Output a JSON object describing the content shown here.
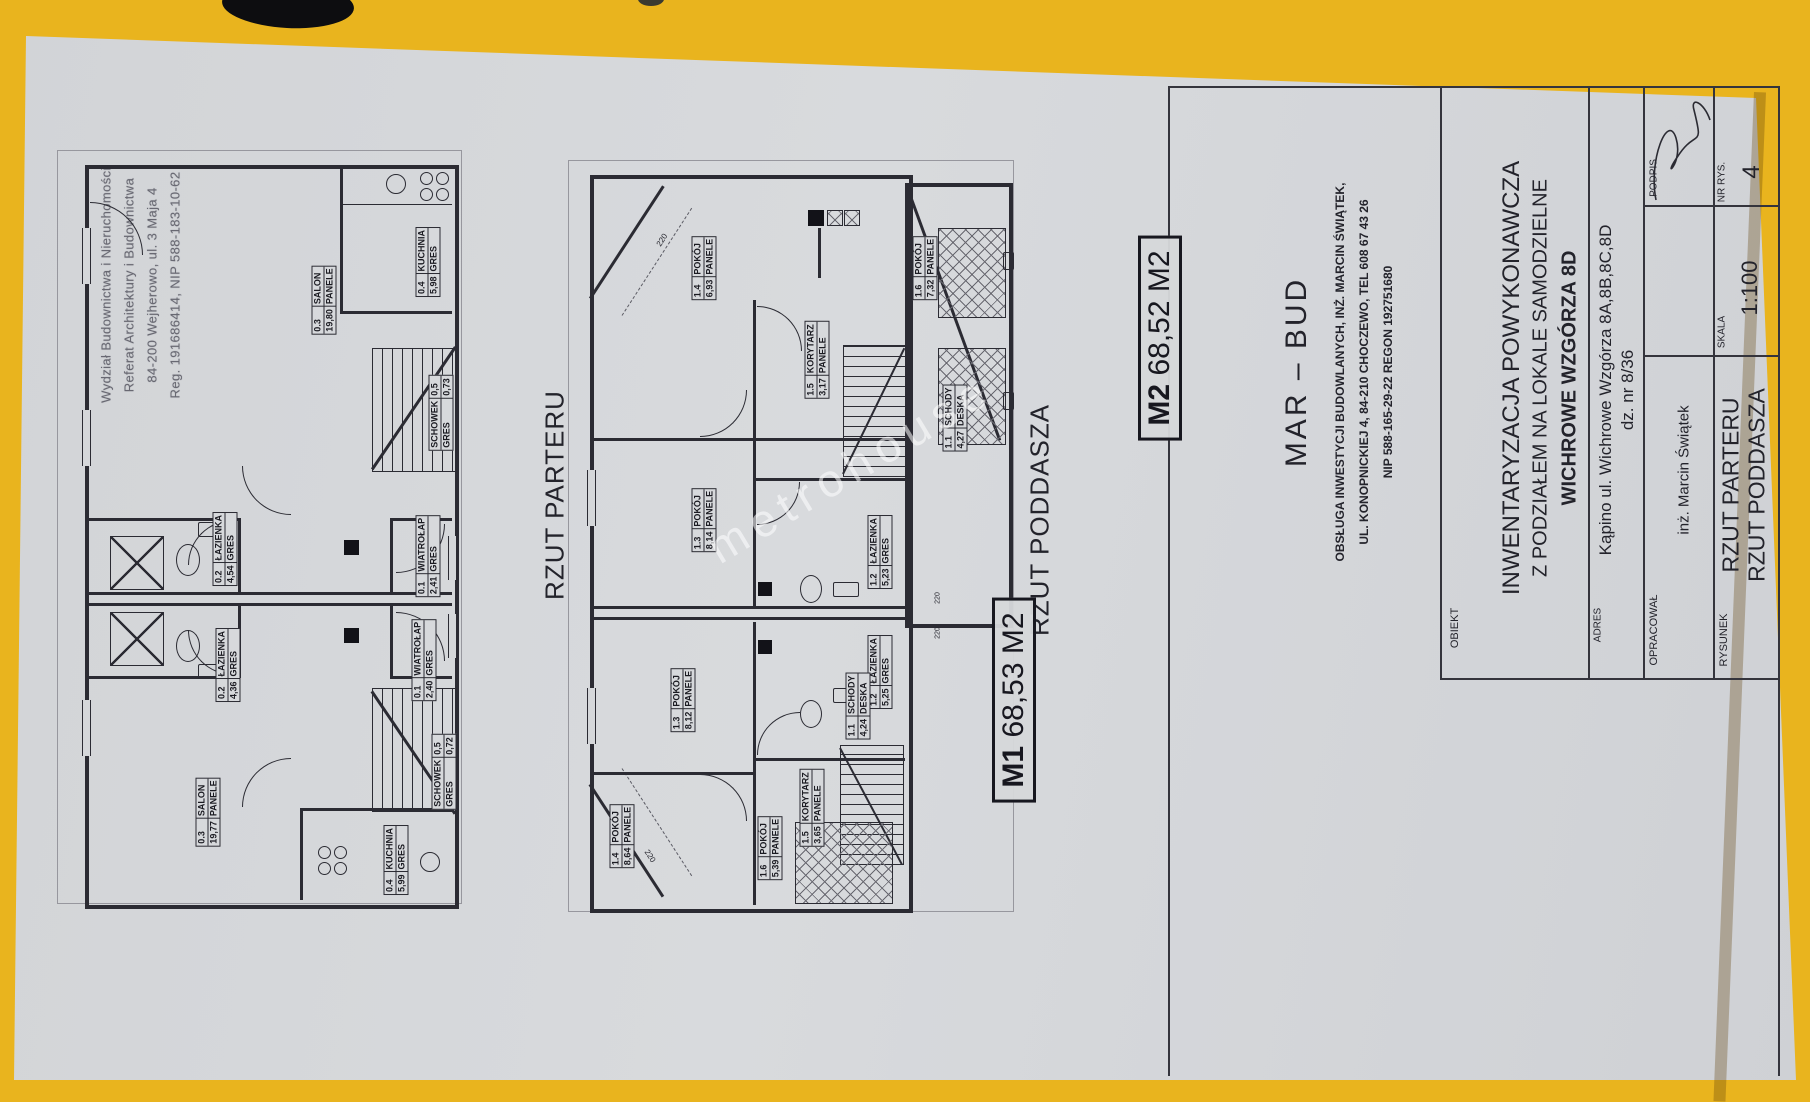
{
  "photo": {
    "surface_color": "#e9b41e",
    "paper_color": "#d4d6d9",
    "ink_color": "#2b2b33"
  },
  "watermark": {
    "text": "metrohouse"
  },
  "stamp": {
    "lines": [
      "Wydział Budownictwa i Nieruchomości",
      "Referat Architektury i Budownictwa",
      "84-200 Wejherowo, ul. 3 Maja 4",
      "Reg. 191686414, NIP 588-183-10-62"
    ]
  },
  "plan_titles": {
    "parter": "RZUT PARTERU",
    "poddasze": "RZUT PODDASZA"
  },
  "unit_badges": {
    "m1": {
      "code": "M1",
      "area": "68,53 M2"
    },
    "m2": {
      "code": "M2",
      "area": "68,52 M2"
    }
  },
  "dims": {
    "a": "220",
    "b": "220",
    "c": "220",
    "d": "220"
  },
  "plans": {
    "parter": {
      "rooms": [
        {
          "a": "0.3",
          "b": "SALON",
          "c": "19,80",
          "d": "PANELE"
        },
        {
          "a": "0.4",
          "b": "KUCHNIA",
          "c": "5,98",
          "d": "GRES"
        },
        {
          "a": "SCHOWEK",
          "b": "0,5",
          "c": "GRES",
          "d": "0,73"
        },
        {
          "a": "0.2",
          "b": "ŁAZIENKA",
          "c": "4,54",
          "d": "GRES"
        },
        {
          "a": "0.1",
          "b": "WIATROŁAP",
          "c": "2,41",
          "d": "GRES"
        },
        {
          "a": "0.2",
          "b": "ŁAZIENKA",
          "c": "4,36",
          "d": "GRES"
        },
        {
          "a": "0.1",
          "b": "WIATROŁAP",
          "c": "2,40",
          "d": "GRES"
        },
        {
          "a": "SCHOWEK",
          "b": "0,5",
          "c": "GRES",
          "d": "0,72"
        },
        {
          "a": "0.3",
          "b": "SALON",
          "c": "19,77",
          "d": "PANELE"
        },
        {
          "a": "0.4",
          "b": "KUCHNIA",
          "c": "5,99",
          "d": "GRES"
        }
      ]
    },
    "poddasze": {
      "rooms": [
        {
          "a": "1.4",
          "b": "POKÓJ",
          "c": "6,93",
          "d": "PANELE"
        },
        {
          "a": "1.5",
          "b": "KORYTARZ",
          "c": "3,17",
          "d": "PANELE"
        },
        {
          "a": "1.6",
          "b": "POKÓJ",
          "c": "7,32",
          "d": "PANELE"
        },
        {
          "a": "1.1",
          "b": "SCHODY",
          "c": "4,27",
          "d": "DESKA"
        },
        {
          "a": "1.3",
          "b": "POKÓJ",
          "c": "8,14",
          "d": "PANELE"
        },
        {
          "a": "1.2",
          "b": "ŁAZIENKA",
          "c": "5,23",
          "d": "GRES"
        },
        {
          "a": "1.3",
          "b": "POKÓJ",
          "c": "8,12",
          "d": "PANELE"
        },
        {
          "a": "1.2",
          "b": "ŁAZIENKA",
          "c": "5,25",
          "d": "GRES"
        },
        {
          "a": "1.5",
          "b": "KORYTARZ",
          "c": "3,65",
          "d": "PANELE"
        },
        {
          "a": "1.1",
          "b": "SCHODY",
          "c": "4,24",
          "d": "DESKA"
        },
        {
          "a": "1.4",
          "b": "POKÓJ",
          "c": "8,64",
          "d": "PANELE"
        },
        {
          "a": "1.6",
          "b": "POKÓJ",
          "c": "5,39",
          "d": "PANELE"
        }
      ]
    }
  },
  "title_block": {
    "company": {
      "name": "MAR – BUD",
      "line1": "OBSŁUGA INWESTYCJI BUDOWLANYCH,  INŻ. MARCIN ŚWIĄTEK,",
      "line2": "UL. KONOPNICKIEJ 4, 84-210 CHOCZEWO, TEL 608 67 43 26",
      "line3": "NIP 588-165-29-22      REGON 192751680"
    },
    "obiekt": {
      "label": "OBIEKT",
      "line1": "INWENTARYZACJA POWYKONAWCZA",
      "line2": "Z PODZIAŁEM NA LOKALE SAMODZIELNE",
      "line3": "WICHROWE WZGÓRZA  8D"
    },
    "adres": {
      "label": "ADRES",
      "line1": "Kąpino ul. Wichrowe Wzgórza 8A,8B,8C,8D",
      "line2": "dz. nr 8/36"
    },
    "opracowal": {
      "label": "OPRACOWAŁ",
      "value": "inż. Marcin Świątek",
      "podpis_label": "PODPIS"
    },
    "rysunek": {
      "label": "RYSUNEK",
      "line1": "RZUT PARTERU",
      "line2": "RZUT PODDASZA",
      "skala_label": "SKALA",
      "skala_value": "1:100",
      "nr_label": "NR RYS.",
      "nr_value": "4"
    }
  }
}
